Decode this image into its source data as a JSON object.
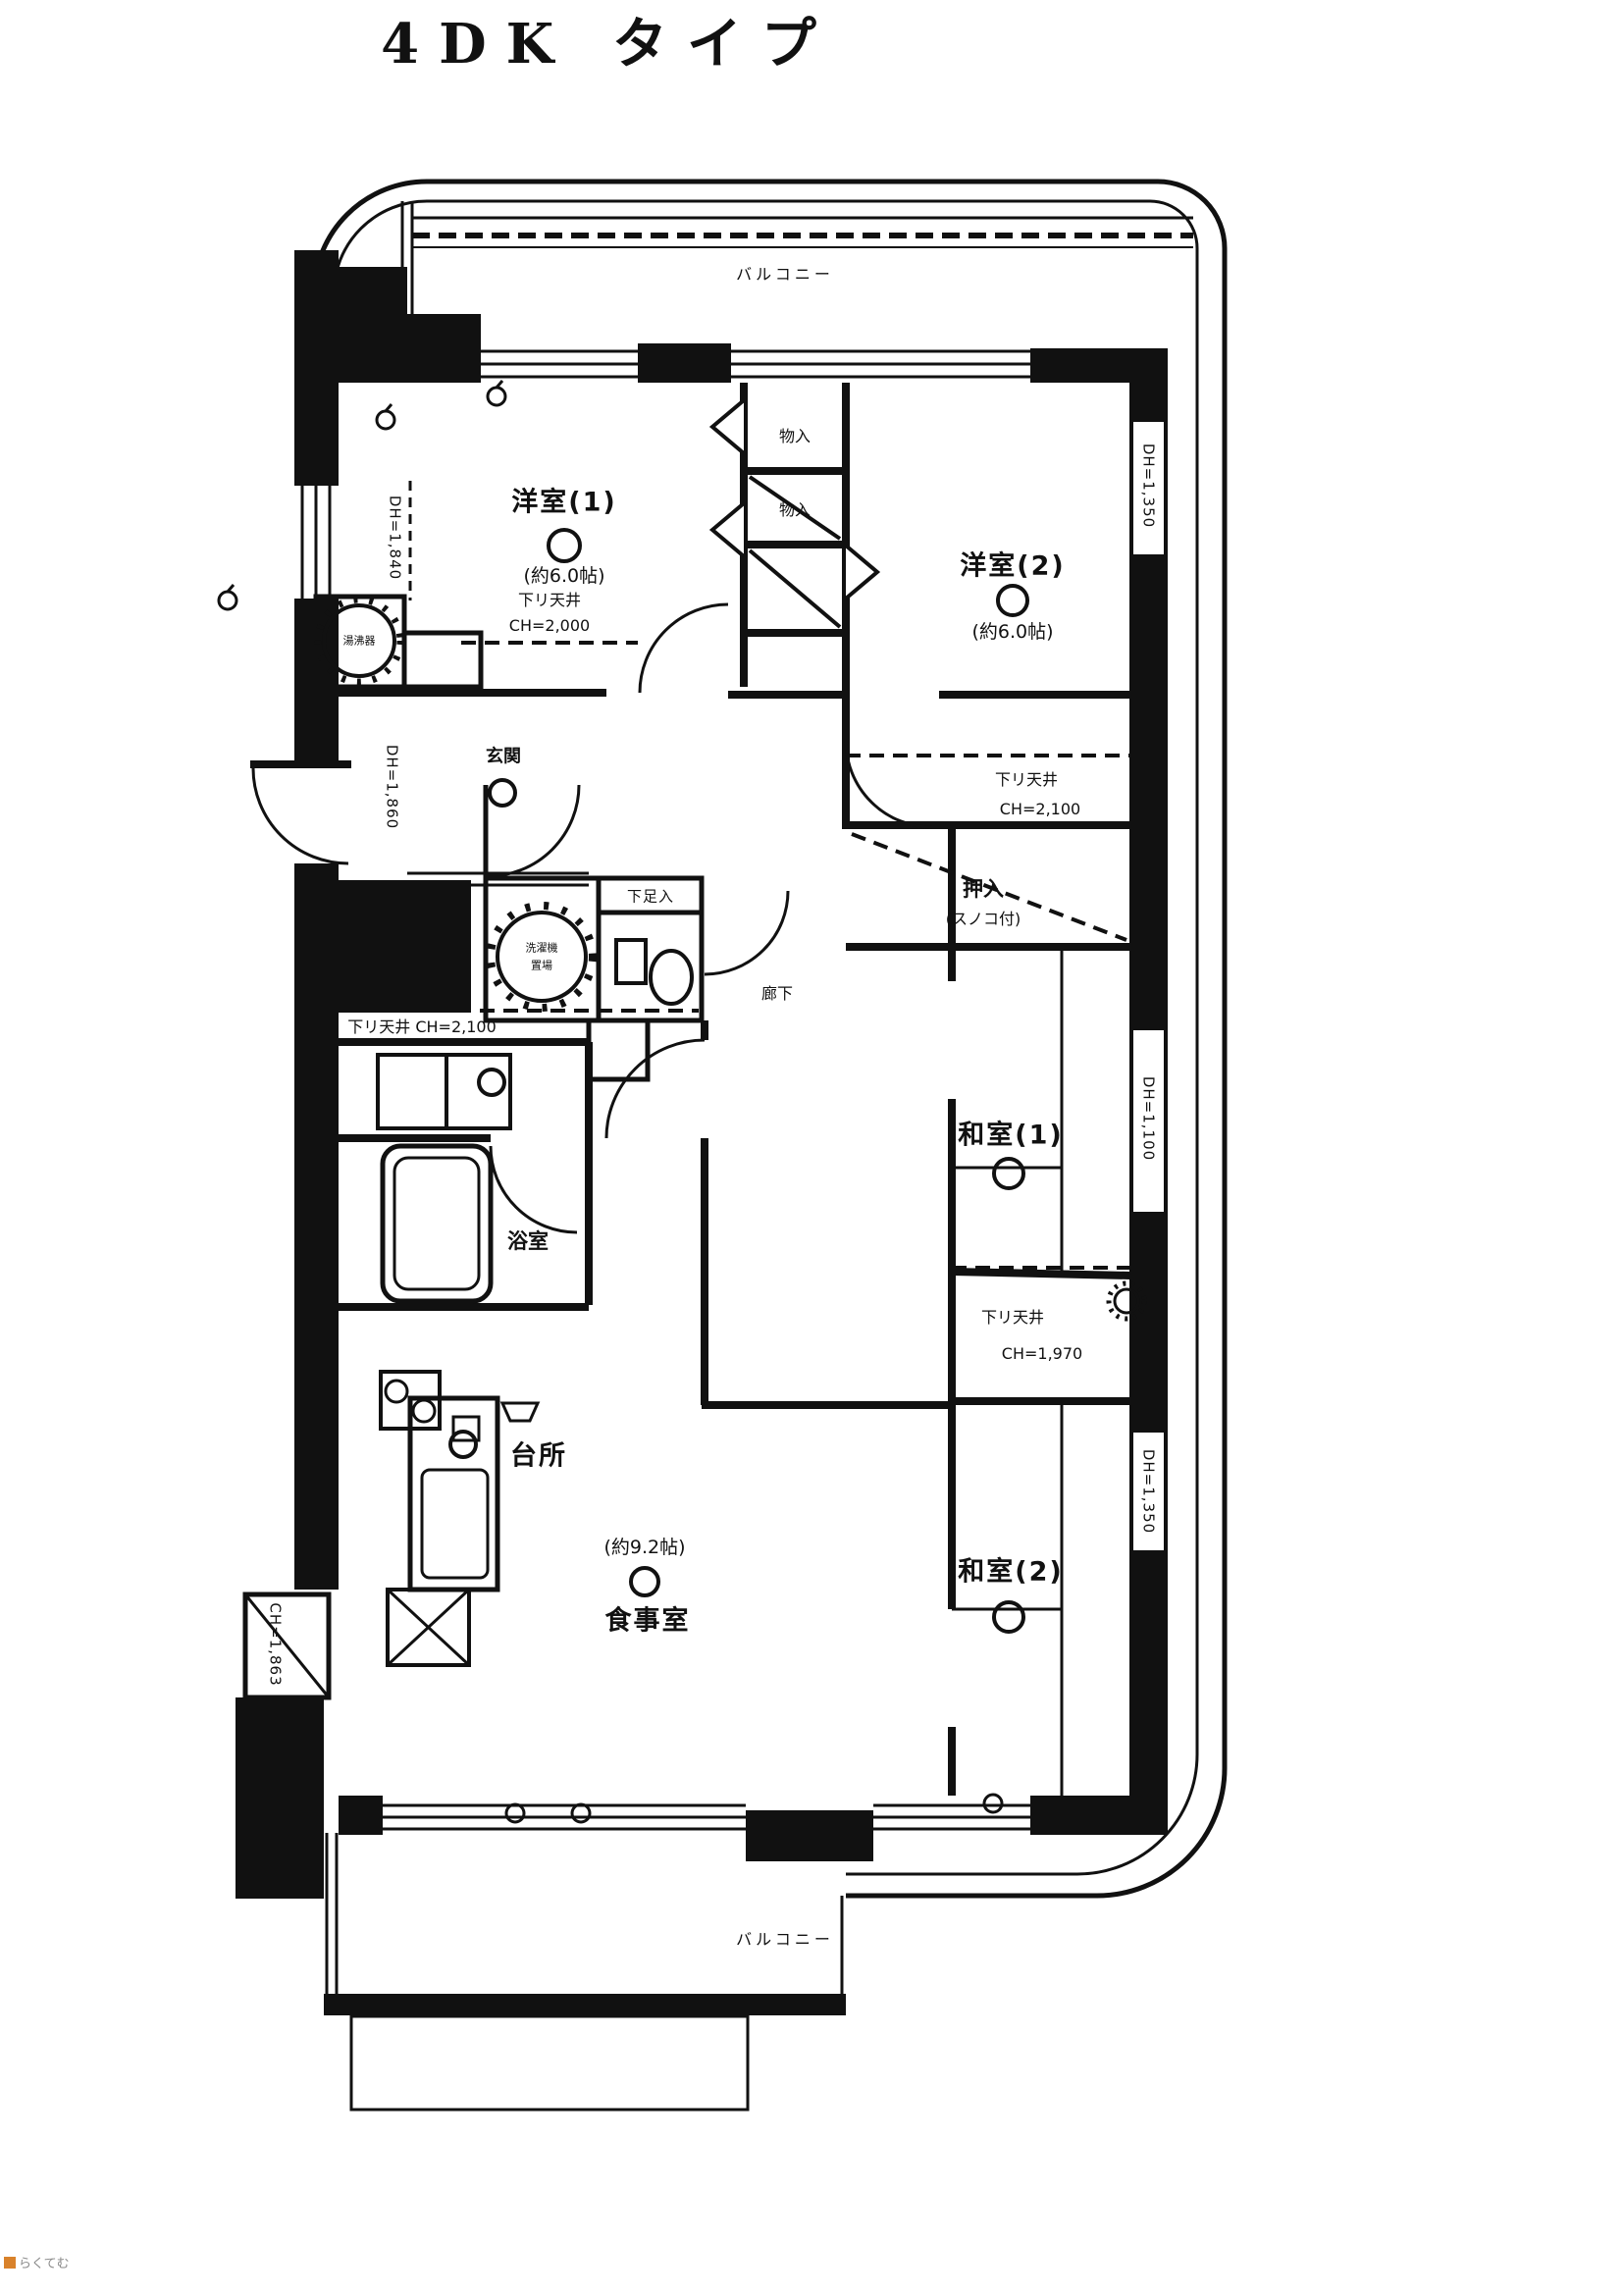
{
  "title": "4DK タイプ",
  "balcony": {
    "top": "バルコニー",
    "bottom": "バルコニー"
  },
  "rooms": {
    "western1": {
      "name": "洋室(1)",
      "size": "(約6.0帖)"
    },
    "western2": {
      "name": "洋室(2)",
      "size": "(約6.0帖)"
    },
    "japanese1": {
      "name": "和室(1)"
    },
    "japanese2": {
      "name": "和室(2)"
    },
    "kitchen": {
      "name": "台所"
    },
    "dining": {
      "name": "食事室",
      "size": "(約9.2帖)"
    },
    "entrance": {
      "name": "玄関"
    },
    "bath": {
      "name": "浴室"
    },
    "corridor": {
      "name": "廊下"
    },
    "closet1": {
      "name": "物入"
    },
    "closet2": {
      "name": "物入"
    },
    "oshiire": {
      "name": "押入",
      "note": "(スノコ付)"
    },
    "shoebox": {
      "name": "下足入"
    },
    "laundry": {
      "line1": "洗濯機",
      "line2": "置場"
    },
    "water_heater": {
      "name": "湯沸器"
    }
  },
  "ceiling_notes": {
    "lowered_ceiling": "下リ天井",
    "hall_ch": "CH=2,000",
    "anteroom_ch": "CH=2,100",
    "kitchen_line": "下リ天井 CH=2,100",
    "japanese2_ch": "CH=1,970"
  },
  "wall_marks": {
    "left_upper": "DH=1,840",
    "left_lower": "DH=1,860",
    "right_upper": "DH=1,350",
    "right_middle": "DH=1,100",
    "right_lower": "DH=1,350",
    "bottom_left": "CH=1,863"
  },
  "watermark": "らくてむ",
  "colors": {
    "ink": "#111111",
    "paper": "#ffffff",
    "watermark_accent": "#d9822b"
  }
}
